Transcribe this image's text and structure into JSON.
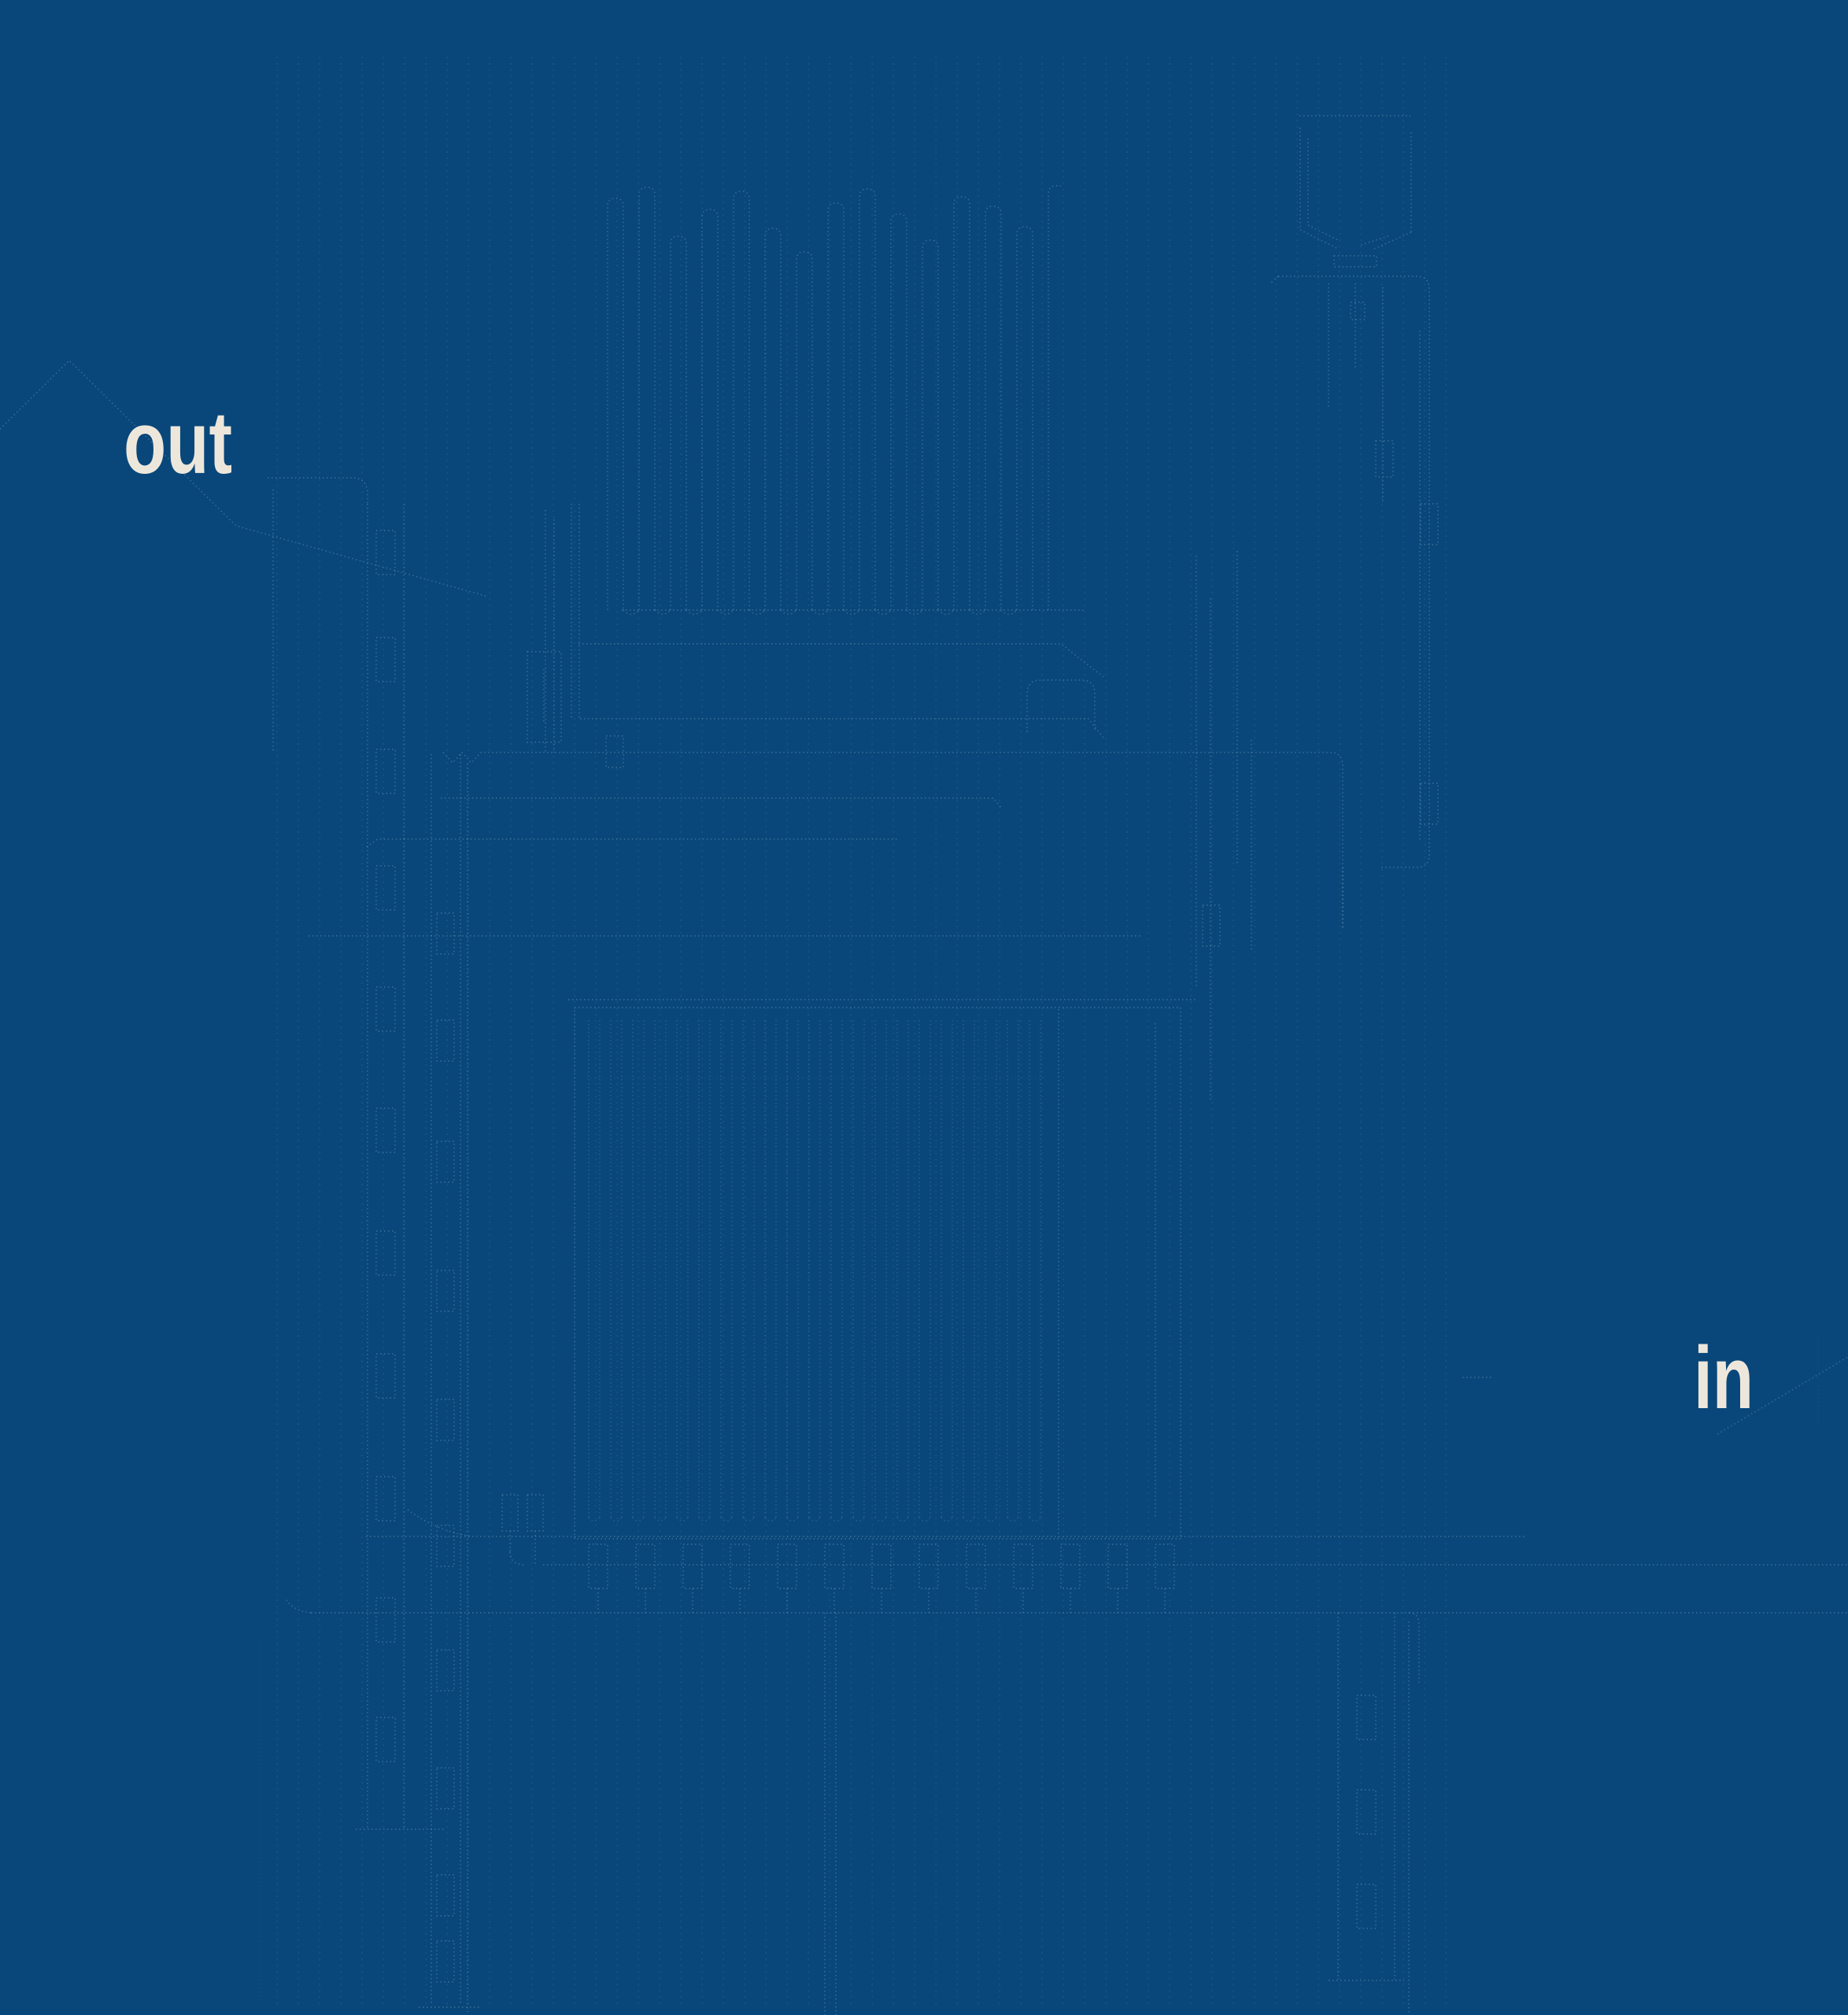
{
  "poster": {
    "labels": {
      "out": "out",
      "in": "in"
    },
    "colors": {
      "background": "#09477A",
      "label": "#EDE7DB",
      "trace": "#9FC0DC"
    }
  }
}
